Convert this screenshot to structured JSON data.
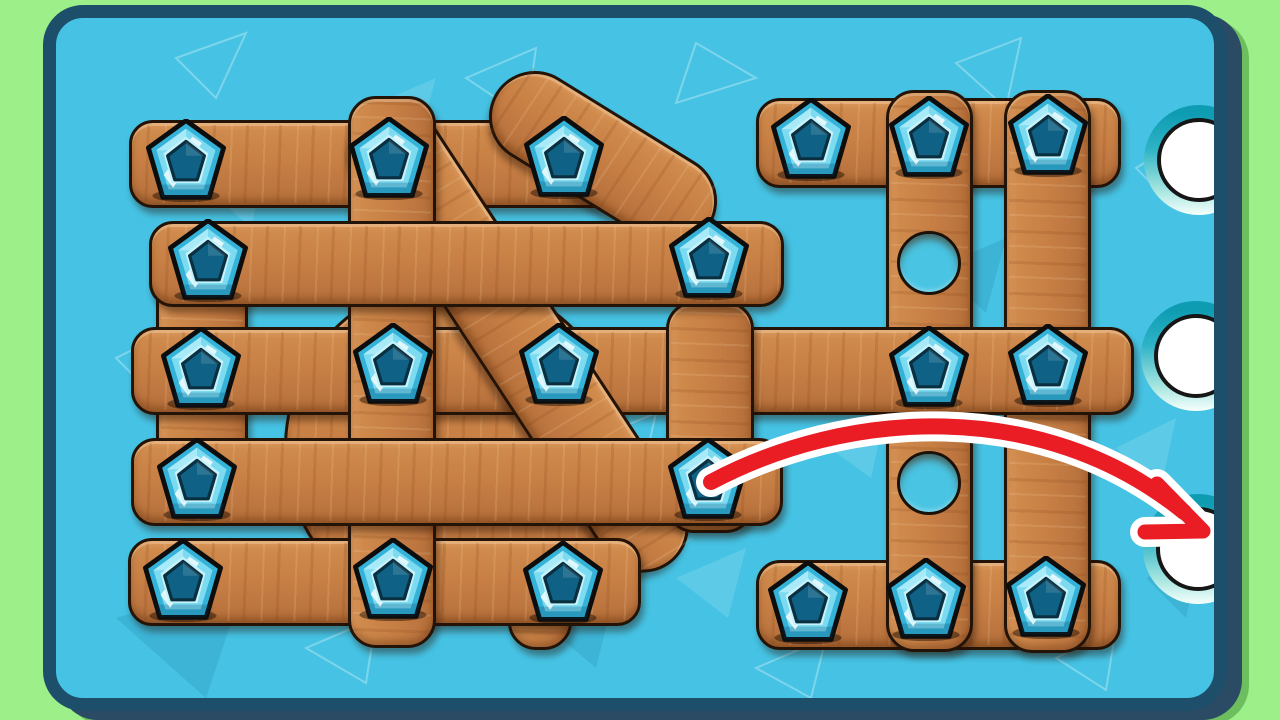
{
  "board": {
    "background_color": "#46c3e4",
    "border_color": "#1d4f6b",
    "frame_color": "#9df089",
    "frame_shadow_color": "#2b4a63",
    "wood_color": "#c88045",
    "wood_edge_color": "#241307"
  },
  "planks": [
    {
      "name": "back-disc",
      "shape": "circle",
      "cx": 398,
      "cy": 430,
      "r": 170
    },
    {
      "name": "back-vertical-left",
      "shape": "rect",
      "dir": "v",
      "x": 100,
      "y": 238,
      "w": 92,
      "h": 252
    },
    {
      "name": "right-top-horizontal",
      "shape": "rect",
      "dir": "h",
      "x": 700,
      "y": 80,
      "w": 365,
      "h": 90
    },
    {
      "name": "right-bottom-horizontal",
      "shape": "rect",
      "dir": "h",
      "x": 700,
      "y": 542,
      "w": 365,
      "h": 90
    },
    {
      "name": "right-vertical-center",
      "shape": "rect",
      "dir": "v",
      "x": 830,
      "y": 72,
      "w": 87,
      "h": 562
    },
    {
      "name": "right-vertical-right",
      "shape": "rect",
      "dir": "v",
      "x": 948,
      "y": 72,
      "w": 87,
      "h": 563
    },
    {
      "name": "long-middle-horizontal",
      "shape": "rect",
      "dir": "h",
      "x": 75,
      "y": 309,
      "w": 1003,
      "h": 88
    },
    {
      "name": "left-top-horizontal",
      "shape": "rect",
      "dir": "h",
      "x": 73,
      "y": 102,
      "w": 512,
      "h": 88
    },
    {
      "name": "stub-vertical-bottom",
      "shape": "rect",
      "dir": "v",
      "x": 452,
      "y": 540,
      "w": 64,
      "h": 92
    },
    {
      "name": "diagonal-short",
      "shape": "rect",
      "dir": "d",
      "cx": 547,
      "cy": 141,
      "w": 252,
      "h": 92,
      "rot": 31.7
    },
    {
      "name": "diagonal-long",
      "shape": "rect",
      "dir": "d",
      "cx": 463,
      "cy": 321,
      "w": 541,
      "h": 92,
      "rot": 56.7
    },
    {
      "name": "left-bottom-horizontal",
      "shape": "rect",
      "dir": "h",
      "x": 72,
      "y": 520,
      "w": 513,
      "h": 88
    },
    {
      "name": "left-vertical-a",
      "shape": "rect",
      "dir": "v",
      "x": 292,
      "y": 78,
      "w": 88,
      "h": 552
    },
    {
      "name": "left-vertical-b",
      "shape": "rect",
      "dir": "v",
      "x": 610,
      "y": 283,
      "w": 88,
      "h": 232
    },
    {
      "name": "left-row2-horizontal",
      "shape": "rect",
      "dir": "h",
      "x": 93,
      "y": 203,
      "w": 635,
      "h": 86
    },
    {
      "name": "left-row4-horizontal",
      "shape": "rect",
      "dir": "h",
      "x": 75,
      "y": 420,
      "w": 652,
      "h": 88
    }
  ],
  "holes": [
    {
      "x": 873,
      "y": 245,
      "r": 32
    },
    {
      "x": 873,
      "y": 465,
      "r": 32
    }
  ],
  "screws": [
    {
      "x": 130,
      "y": 143
    },
    {
      "x": 333,
      "y": 141
    },
    {
      "x": 508,
      "y": 140
    },
    {
      "x": 152,
      "y": 243
    },
    {
      "x": 653,
      "y": 241
    },
    {
      "x": 145,
      "y": 351
    },
    {
      "x": 337,
      "y": 347
    },
    {
      "x": 503,
      "y": 347
    },
    {
      "x": 141,
      "y": 462
    },
    {
      "x": 652,
      "y": 462
    },
    {
      "x": 127,
      "y": 563
    },
    {
      "x": 337,
      "y": 562
    },
    {
      "x": 507,
      "y": 565
    },
    {
      "x": 755,
      "y": 122
    },
    {
      "x": 873,
      "y": 120
    },
    {
      "x": 992,
      "y": 118
    },
    {
      "x": 873,
      "y": 350
    },
    {
      "x": 992,
      "y": 348
    },
    {
      "x": 752,
      "y": 585
    },
    {
      "x": 870,
      "y": 582
    },
    {
      "x": 990,
      "y": 580
    }
  ],
  "screw_style": {
    "size": 80,
    "outer_color": "#35b2d8",
    "face_color": "#7cdaf1",
    "center_color": "#0f6286",
    "outline_color": "#0d0d0d"
  },
  "slots": [
    {
      "x": 1143,
      "y": 142
    },
    {
      "x": 1140,
      "y": 338
    },
    {
      "x": 1142,
      "y": 531
    }
  ],
  "slot_style": {
    "radius": 42,
    "ring_radius": 55,
    "ring_color": "#14a2b8"
  },
  "arrow": {
    "color": "#ea1c24",
    "outline_color": "#ffffff",
    "path": "M 655 464 C 790 392, 985 378, 1128 494",
    "head_points": "1101,466 1147,513 1089,514"
  },
  "counts": {
    "screws": 21,
    "empty_holes": 2,
    "target_slots": 3
  }
}
